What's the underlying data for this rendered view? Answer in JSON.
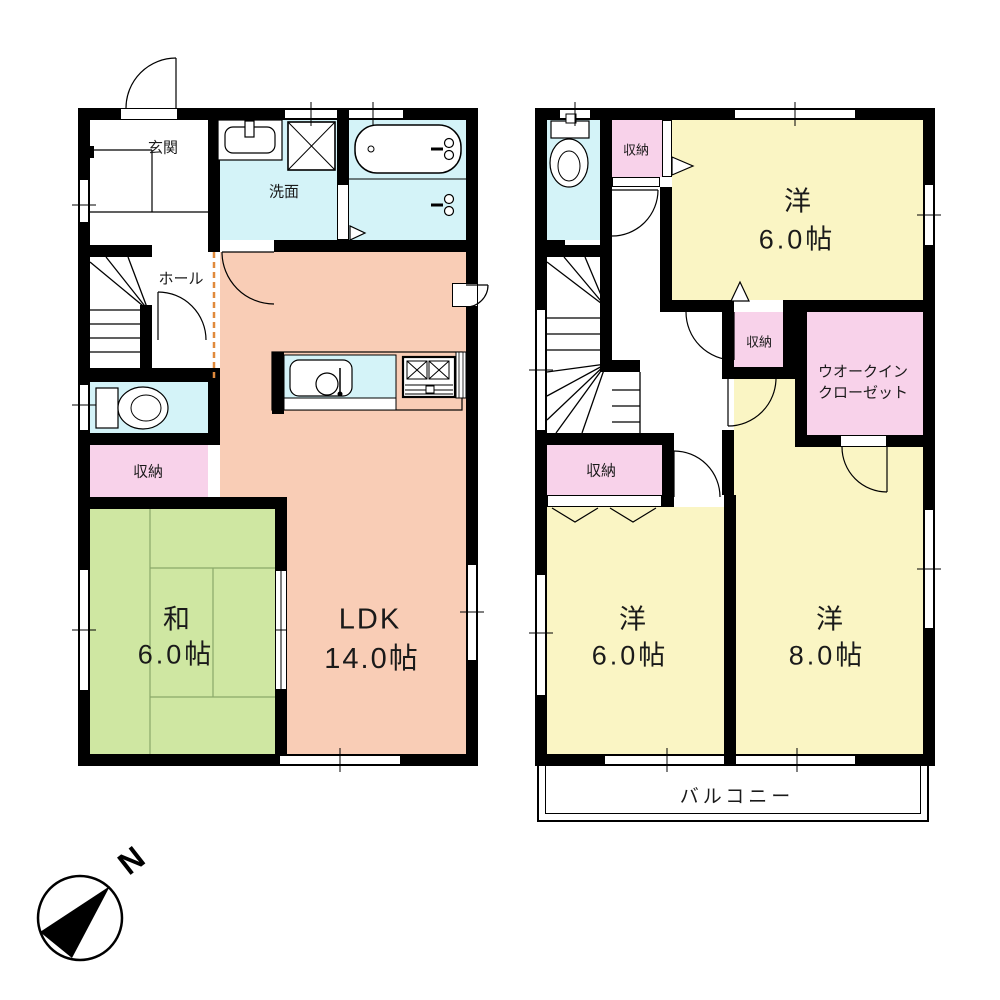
{
  "colors": {
    "wall": "#000000",
    "ldk": "#f9cdb6",
    "tatami": "#cfe7a2",
    "bedroom": "#faf5c4",
    "closet": "#f8d2ea",
    "water": "#d4f3f8",
    "white": "#ffffff",
    "hall_boundary_dash": "#e08a3c"
  },
  "floor1": {
    "genkan": "玄関",
    "washroom": "洗面",
    "hall": "ホール",
    "storage": "収納",
    "washitsu": {
      "name": "和",
      "area": "6.0帖"
    },
    "ldk": {
      "name": "LDK",
      "area": "14.0帖"
    }
  },
  "floor2": {
    "storage_top": "収納",
    "bedroom_top": {
      "name": "洋",
      "area": "6.0帖"
    },
    "storage_mid": "収納",
    "wic": {
      "line1": "ウオークイン",
      "line2": "クローゼット"
    },
    "storage_left": "収納",
    "bedroom_left": {
      "name": "洋",
      "area": "6.0帖"
    },
    "bedroom_right": {
      "name": "洋",
      "area": "8.0帖"
    },
    "balcony": "バルコニー"
  },
  "compass": {
    "north": "N"
  }
}
